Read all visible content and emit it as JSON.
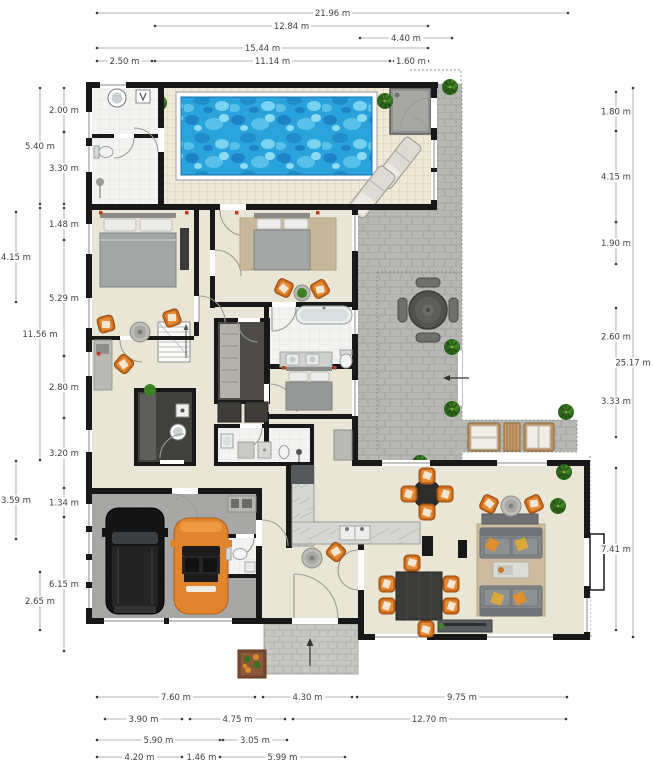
{
  "canvas": {
    "width": 653,
    "height": 768
  },
  "unit": "m",
  "colors": {
    "page": "#ffffff",
    "wall": "#181818",
    "floor_interior": "#e9e6d6",
    "floor_bath": "#f3f3f1",
    "pool_water": "#2aa3dc",
    "pool_water_dark": "#1d83c6",
    "pool_water_light": "#8edcf4",
    "deck_tile": "#f0e9d8",
    "patio_paver": "#b7b7b3",
    "path_paver": "#c7c7c3",
    "garage_floor": "#a7a7a5",
    "accent_orange": "#d2691e",
    "car_orange": "#e0852b",
    "car_black": "#141414",
    "sofa_gray": "#84878a",
    "rug_tan": "#cdbb9d",
    "wood": "#bb9261",
    "plant_green": "#2c641c",
    "dim_line": "#9c9c9c",
    "dim_text": "#3d3d3d",
    "light_dot_red": "#bf3a16"
  },
  "dimensions": {
    "top": [
      {
        "label": "21.96 m",
        "x1": 97,
        "x2": 568,
        "y": 13
      },
      {
        "label": "12.84 m",
        "x1": 155,
        "x2": 428,
        "y": 26
      },
      {
        "label": "4.40 m",
        "x1": 360,
        "x2": 452,
        "y": 38
      },
      {
        "label": "15.44 m",
        "x1": 97,
        "x2": 428,
        "y": 48
      },
      {
        "label": "2.50 m",
        "x1": 97,
        "x2": 152,
        "y": 61
      },
      {
        "label": "11.14 m",
        "x1": 155,
        "x2": 390,
        "y": 61
      },
      {
        "label": "1.60 m",
        "x1": 394,
        "x2": 428,
        "y": 61
      }
    ],
    "left": [
      {
        "label": "2.00 m",
        "x": 64,
        "y1": 88,
        "y2": 132
      },
      {
        "label": "3.30 m",
        "x": 64,
        "y1": 132,
        "y2": 204
      },
      {
        "label": "1.48 m",
        "x": 64,
        "y1": 208,
        "y2": 240
      },
      {
        "label": "5.29 m",
        "x": 64,
        "y1": 240,
        "y2": 356
      },
      {
        "label": "2.80 m",
        "x": 64,
        "y1": 356,
        "y2": 418
      },
      {
        "label": "3.20 m",
        "x": 64,
        "y1": 418,
        "y2": 488
      },
      {
        "label": "1.34 m",
        "x": 64,
        "y1": 488,
        "y2": 517
      },
      {
        "label": "6.15 m",
        "x": 64,
        "y1": 517,
        "y2": 651
      },
      {
        "label": "5.40 m",
        "x": 40,
        "y1": 88,
        "y2": 204
      },
      {
        "label": "11.56 m",
        "x": 40,
        "y1": 208,
        "y2": 460
      },
      {
        "label": "2.65 m",
        "x": 40,
        "y1": 572,
        "y2": 630
      },
      {
        "label": "4.15 m",
        "x": 16,
        "y1": 212,
        "y2": 302
      },
      {
        "label": "3.59 m",
        "x": 16,
        "y1": 461,
        "y2": 539
      }
    ],
    "right": [
      {
        "label": "1.80 m",
        "x": 616,
        "y1": 92,
        "y2": 131
      },
      {
        "label": "4.15 m",
        "x": 616,
        "y1": 131,
        "y2": 222
      },
      {
        "label": "1.90 m",
        "x": 616,
        "y1": 222,
        "y2": 264
      },
      {
        "label": "2.60 m",
        "x": 616,
        "y1": 308,
        "y2": 365
      },
      {
        "label": "3.33 m",
        "x": 616,
        "y1": 365,
        "y2": 437
      },
      {
        "label": "7.41 m",
        "x": 616,
        "y1": 468,
        "y2": 630
      },
      {
        "label": "25.17 m",
        "x": 633,
        "y1": 88,
        "y2": 637
      }
    ],
    "bottom": [
      {
        "label": "7.60 m",
        "x1": 97,
        "x2": 255,
        "y": 697
      },
      {
        "label": "4.30 m",
        "x1": 263,
        "x2": 352,
        "y": 697
      },
      {
        "label": "9.75 m",
        "x1": 357,
        "x2": 567,
        "y": 697
      },
      {
        "label": "3.90 m",
        "x1": 105,
        "x2": 182,
        "y": 719
      },
      {
        "label": "4.75 m",
        "x1": 190,
        "x2": 285,
        "y": 719
      },
      {
        "label": "12.70 m",
        "x1": 293,
        "x2": 566,
        "y": 719
      },
      {
        "label": "5.90 m",
        "x1": 97,
        "x2": 220,
        "y": 740
      },
      {
        "label": "3.05 m",
        "x1": 223,
        "x2": 287,
        "y": 740
      },
      {
        "label": "4.20 m",
        "x1": 97,
        "x2": 182,
        "y": 757
      },
      {
        "label": "1.46 m",
        "x1": 188,
        "x2": 215,
        "y": 757
      },
      {
        "label": "5.99 m",
        "x1": 220,
        "x2": 345,
        "y": 757
      }
    ]
  },
  "objects": [
    "swimming-pool",
    "pool-deck",
    "pool-lounger",
    "outdoor-shower-room",
    "patio-pavers",
    "outdoor-dining-table",
    "outdoor-sofa",
    "outdoor-coffee-table",
    "plant",
    "side-gate",
    "double-bed",
    "armchair",
    "side-table",
    "desk",
    "bathtub",
    "vanity-double-sink",
    "toilet",
    "shower",
    "washing-machine",
    "wardrobe",
    "kitchenette",
    "staircase",
    "suv-car",
    "sports-car",
    "garage-cabinet",
    "kitchen-counter",
    "kitchen-sink",
    "fridge",
    "breakfast-table",
    "dining-table",
    "dining-chair",
    "sofa",
    "coffee-table",
    "sideboard",
    "tv-console",
    "rug",
    "entrance-path",
    "entrance-arrow",
    "flower-planter"
  ]
}
